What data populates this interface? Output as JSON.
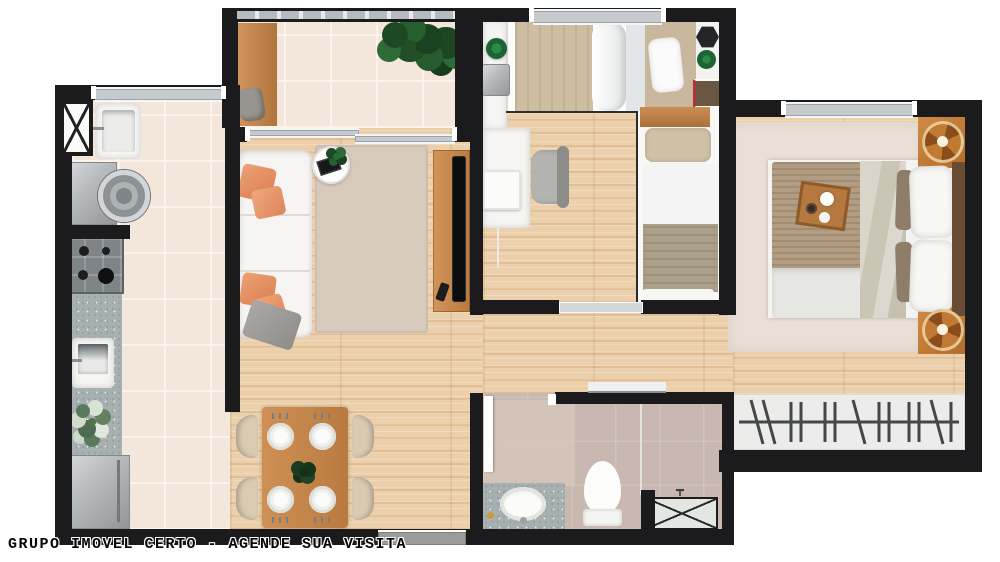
{
  "caption": {
    "text": "GRUPO IMOVEL CERTO - AGENDE SUA VISITA"
  },
  "palette": {
    "wall": "#1b1b1e",
    "wood_floor": "#ecd0ab",
    "tile_floor": "#f3e6db",
    "bathroom_surface": "#c9b8b0",
    "living_rug": "#d7c9bc",
    "master_rug": "#eadfd5",
    "sofa_white": "#f6f5f3",
    "accent_pillow_orange": "#e08a5f",
    "swivel_armchair_orange": "#b96f2e",
    "wood_furniture": "#c8874b",
    "window_glass": "#c6cacd",
    "granite_counter": "#a7b0b0",
    "plant_green": "#2d6b35",
    "appliance_silver": "#b6b9bc"
  }
}
